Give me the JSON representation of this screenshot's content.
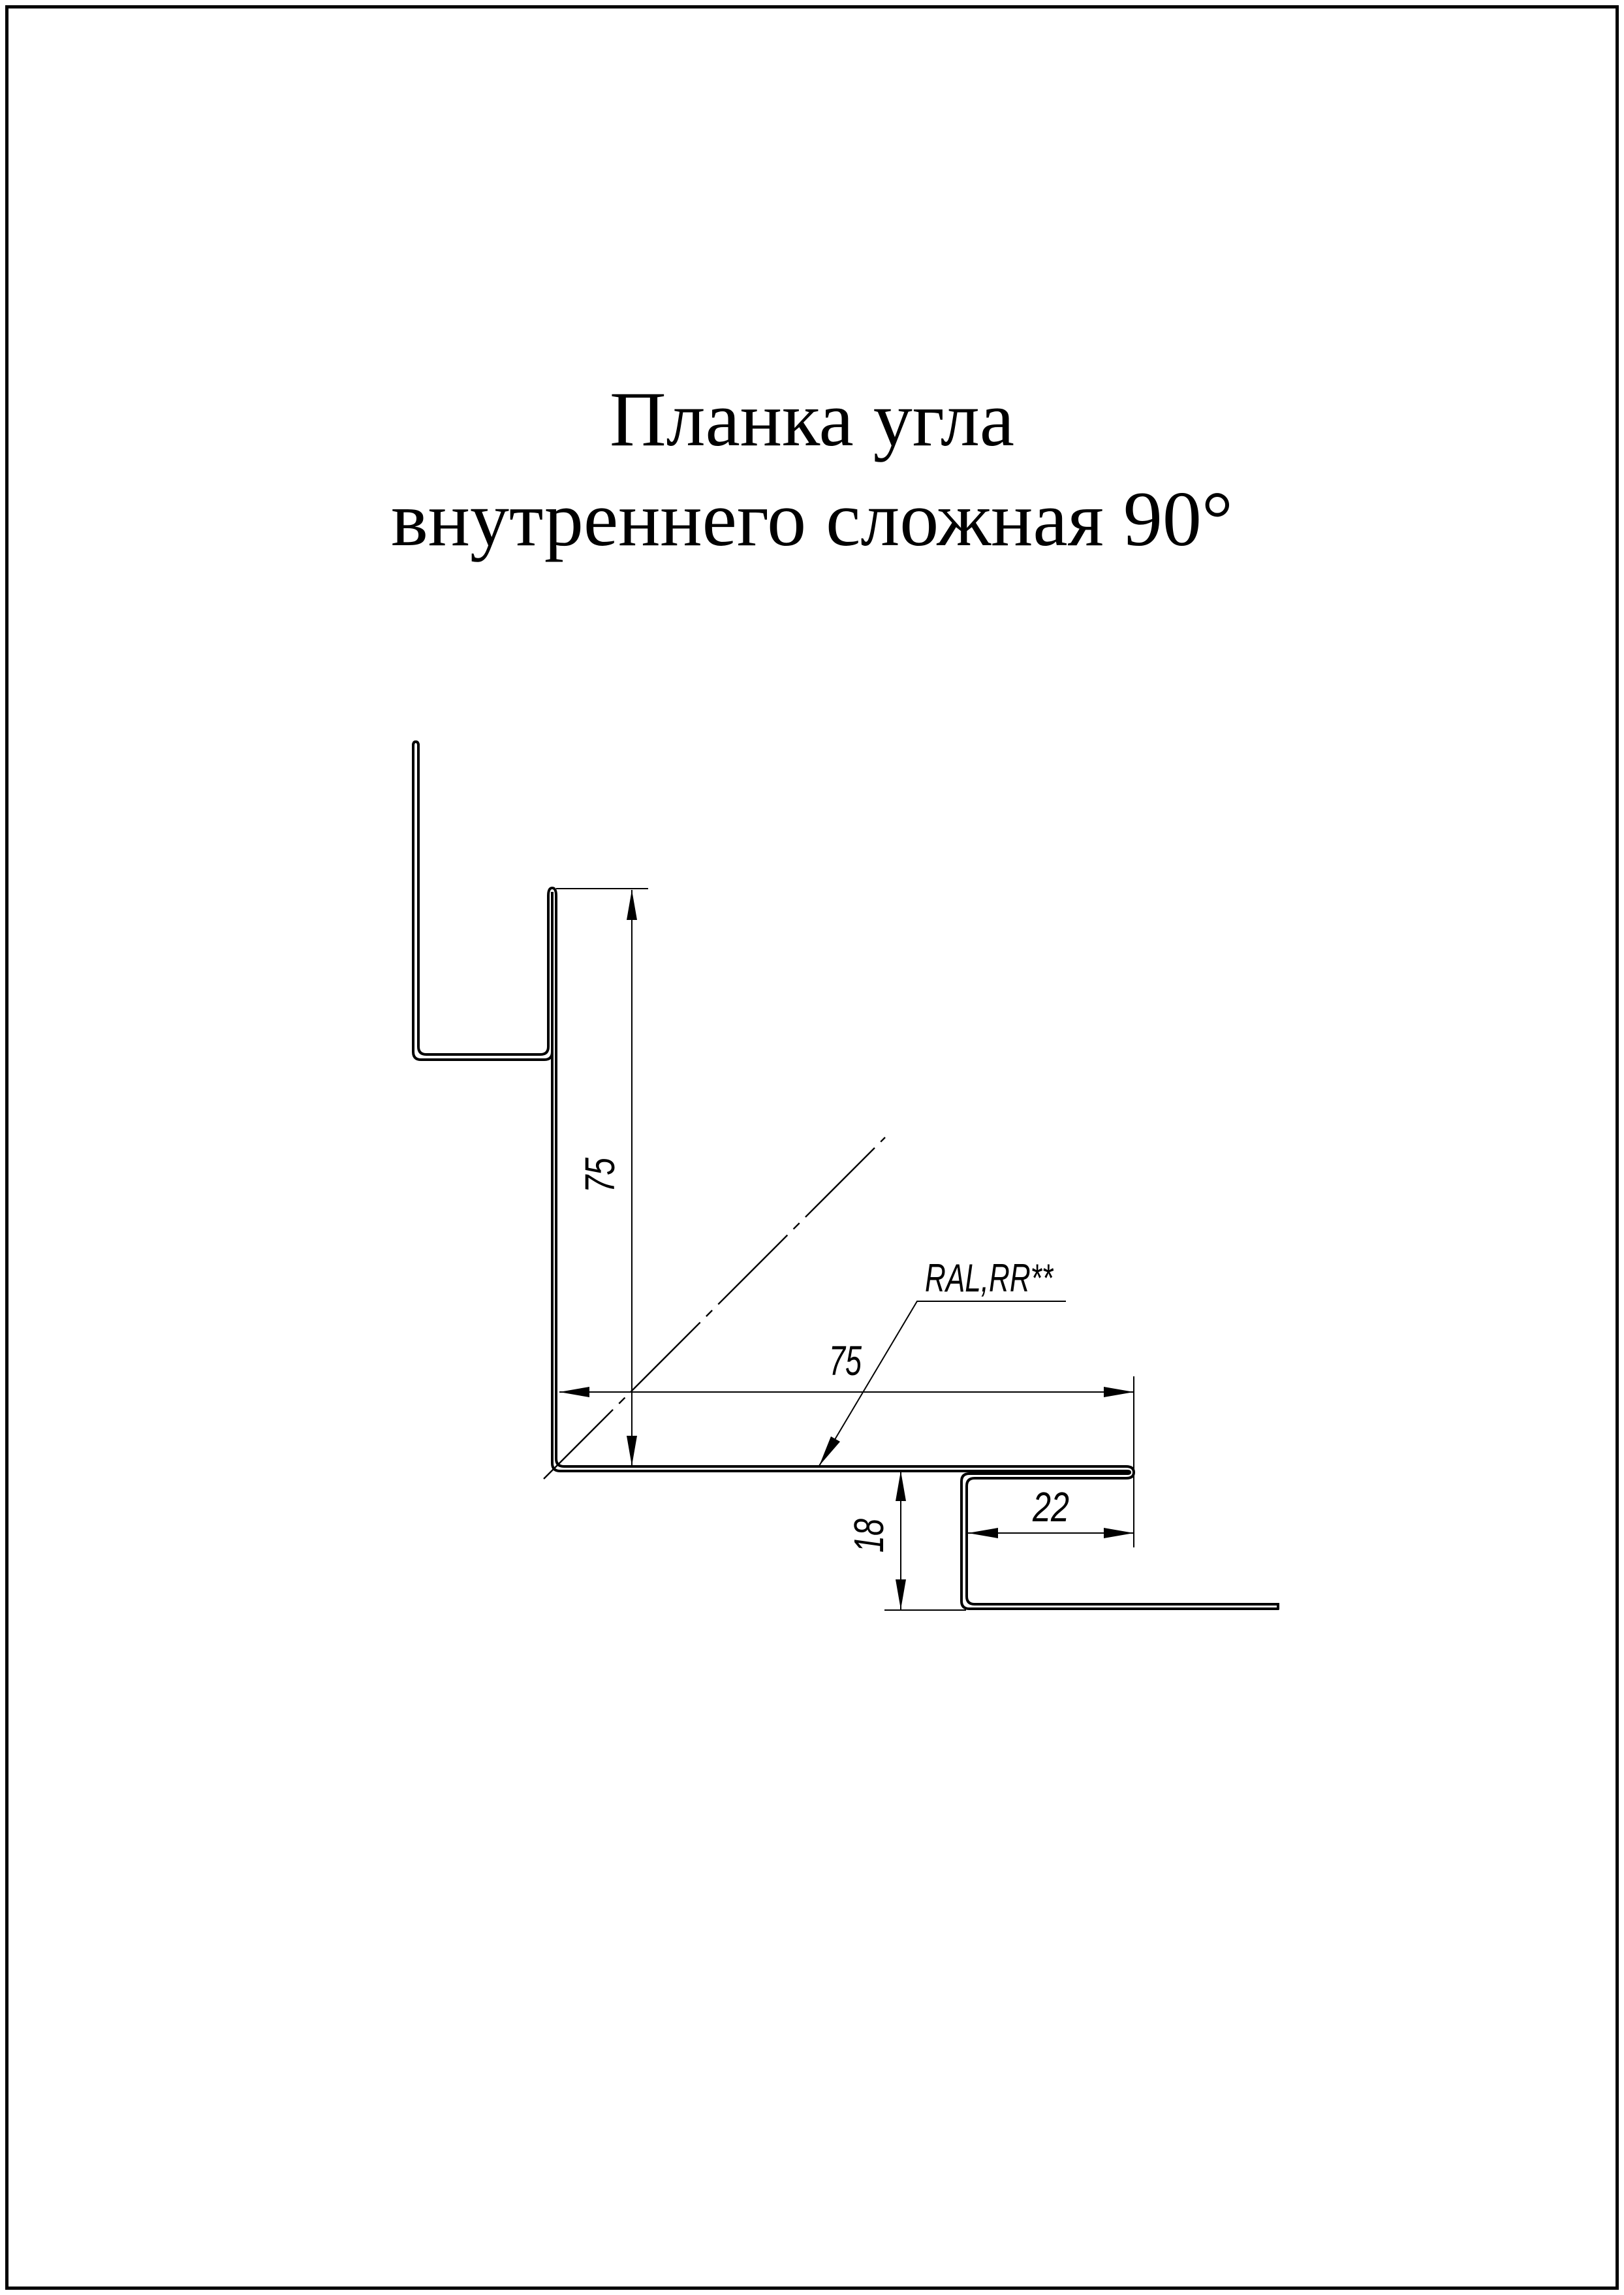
{
  "title": {
    "line1": "Планка угла",
    "line2": "внутреннего сложная 90°"
  },
  "dimensions": {
    "web_height": "75",
    "flange_width": "75",
    "lip_return": "22",
    "lip_depth": "18"
  },
  "labels": {
    "coating": "RAL,RR**"
  },
  "colors": {
    "line": "#000000",
    "background": "#ffffff"
  }
}
